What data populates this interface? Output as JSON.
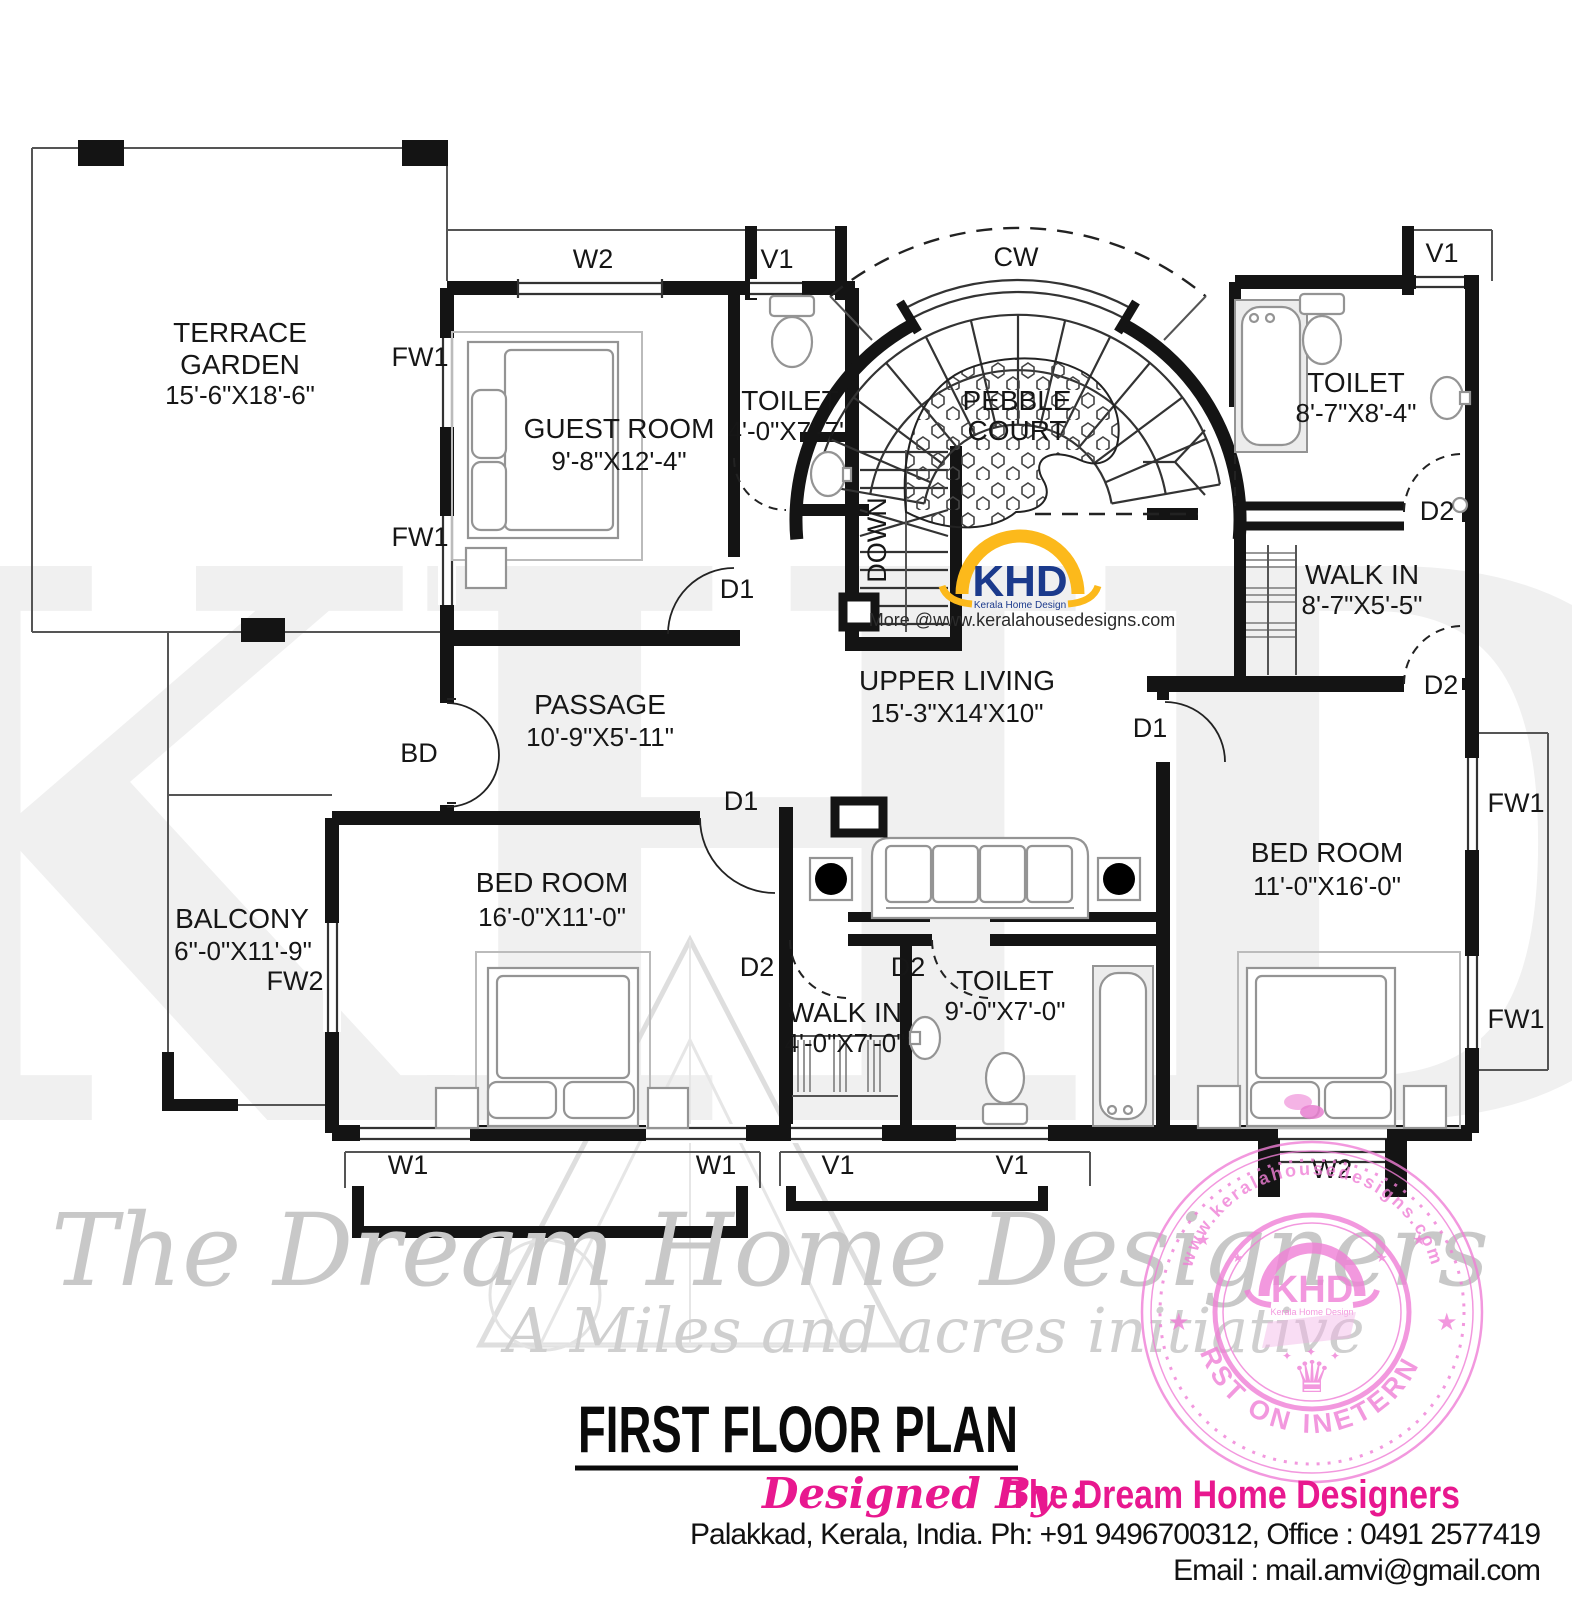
{
  "plan": {
    "rooms": {
      "terrace": {
        "name": "TERRACE",
        "name2": "GARDEN",
        "dim": "15'-6\"X18'-6\""
      },
      "guest": {
        "name": "GUEST ROOM",
        "dim": "9'-8\"X12'-4\""
      },
      "toilet_top": {
        "name": "TOILET",
        "dim": "4'-0\"X7'-7\""
      },
      "pebble": {
        "name": "PEBBLE",
        "name2": "COURT"
      },
      "toilet_right": {
        "name": "TOILET",
        "dim": "8'-7\"X8'-4\""
      },
      "walkin_right": {
        "name": "WALK IN",
        "dim": "8'-7\"X5'-5\""
      },
      "upper_living": {
        "name": "UPPER  LIVING",
        "dim": "15'-3\"X14'X10\""
      },
      "passage": {
        "name": "PASSAGE",
        "dim": "10'-9\"X5'-11\""
      },
      "balcony": {
        "name": "BALCONY",
        "dim": "6\"-0\"X11'-9\""
      },
      "bedroom_left": {
        "name": "BED ROOM",
        "dim": "16'-0\"X11'-0\""
      },
      "walkin_bottom": {
        "name": "WALK IN",
        "dim": "4'-0\"X7'-0\""
      },
      "toilet_bottom": {
        "name": "TOILET",
        "dim": "9'-0\"X7'-0\""
      },
      "bedroom_right": {
        "name": "BED ROOM",
        "dim": "11'-0\"X16'-0\""
      }
    },
    "markers": {
      "w1": "W1",
      "w2": "W2",
      "v1": "V1",
      "fw1": "FW1",
      "fw2": "FW2",
      "d1": "D1",
      "d2": "D2",
      "bd": "BD",
      "cw": "CW",
      "down": "DOWN"
    }
  },
  "logo": {
    "brand": "KHD",
    "tagline": "Kerala Home Design",
    "promo": "More @www.keralahousedesigns.com"
  },
  "watermark": {
    "letters": "KHD",
    "script1": "The Dream Home Designers",
    "script2": "A Miles and acres initiative"
  },
  "stamp": {
    "arc_top": "www.keralahousedesigns.com",
    "arc_bottom": "FIRST ON INETERNET",
    "brand": "KHD",
    "tagline": "Kerala Home Design"
  },
  "titleblock": {
    "title": "FIRST FLOOR PLAN",
    "designed_by": "Designed By :",
    "designer": "The Dream Home Designers",
    "contact": "Palakkad, Kerala, India.  Ph: +91 9496700312, Office : 0491 2577419",
    "email": "Email : mail.amvi@gmail.com"
  },
  "colors": {
    "pink": "#e8188f",
    "stamp_pink": "#f07fd6",
    "logo_yellow": "#fcb91b",
    "logo_navy": "#1b3a8c"
  }
}
